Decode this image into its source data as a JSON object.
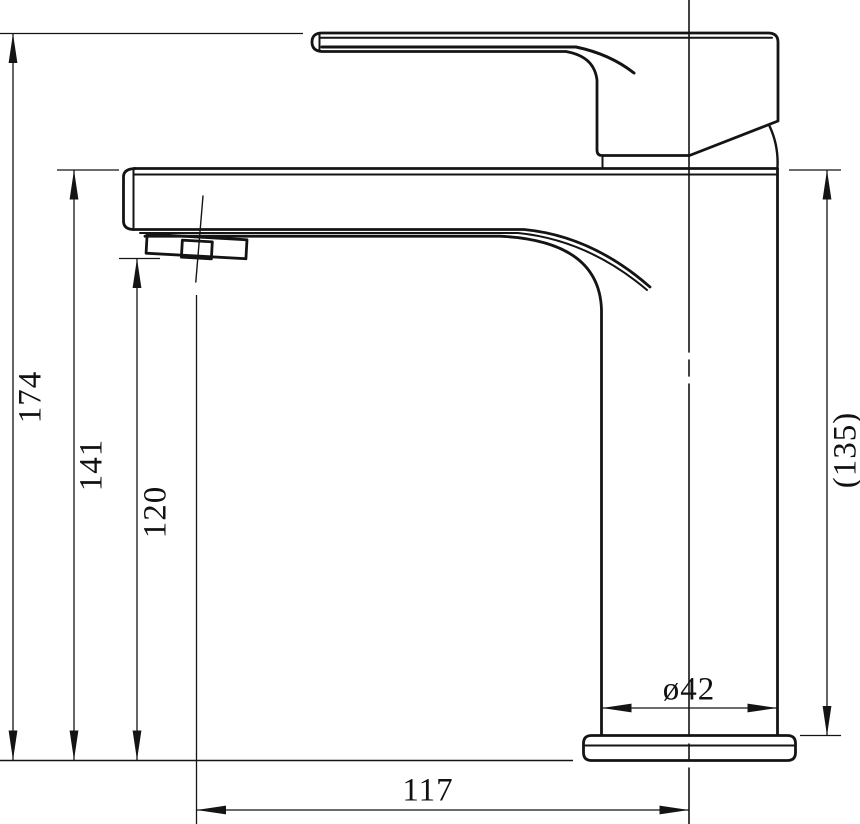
{
  "drawing": {
    "subject": "Single-lever basin mixer faucet — side elevation technical drawing",
    "units": "mm",
    "colors": {
      "line": "#141414",
      "background": "#ffffff"
    },
    "dimensions": {
      "total_height": "174",
      "spout_top_height": "141",
      "outlet_height": "120",
      "body_height_reference": "(135)",
      "base_diameter": "ø42",
      "spout_reach": "117"
    }
  }
}
